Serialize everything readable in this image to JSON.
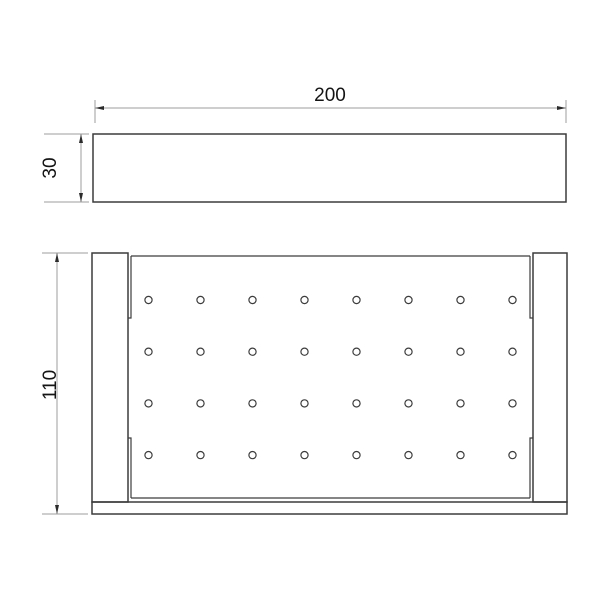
{
  "drawing": {
    "type": "technical-drawing",
    "subject": "perforated tray, two orthographic views",
    "colors": {
      "background": "#ffffff",
      "object_line": "#3c3c3c",
      "dim_line": "#9c9c9c",
      "arrow": "#2b2b2b",
      "text": "#141414"
    },
    "dimensions": {
      "overall_width": {
        "label": "200",
        "orientation": "horizontal",
        "applies_to": "both views"
      },
      "front_height": {
        "label": "30",
        "orientation": "vertical",
        "applies_to": "front view"
      },
      "overall_depth": {
        "label": "110",
        "orientation": "vertical",
        "applies_to": "top view"
      }
    },
    "views": {
      "front": {
        "name": "front view",
        "width_units": 200,
        "height_units": 30
      },
      "top": {
        "name": "top view",
        "width_units": 200,
        "depth_units": 110,
        "features": [
          "left end rail",
          "right end rail",
          "bottom rail",
          "perforated plate"
        ],
        "hole_grid": {
          "rows": 4,
          "cols": 8,
          "total_holes": 32
        }
      }
    },
    "holes": {
      "rows": 4,
      "cols": 8,
      "start_x": 148.5,
      "start_y": 300,
      "dx": 52,
      "dy": 51.7,
      "r": 3.6
    }
  }
}
